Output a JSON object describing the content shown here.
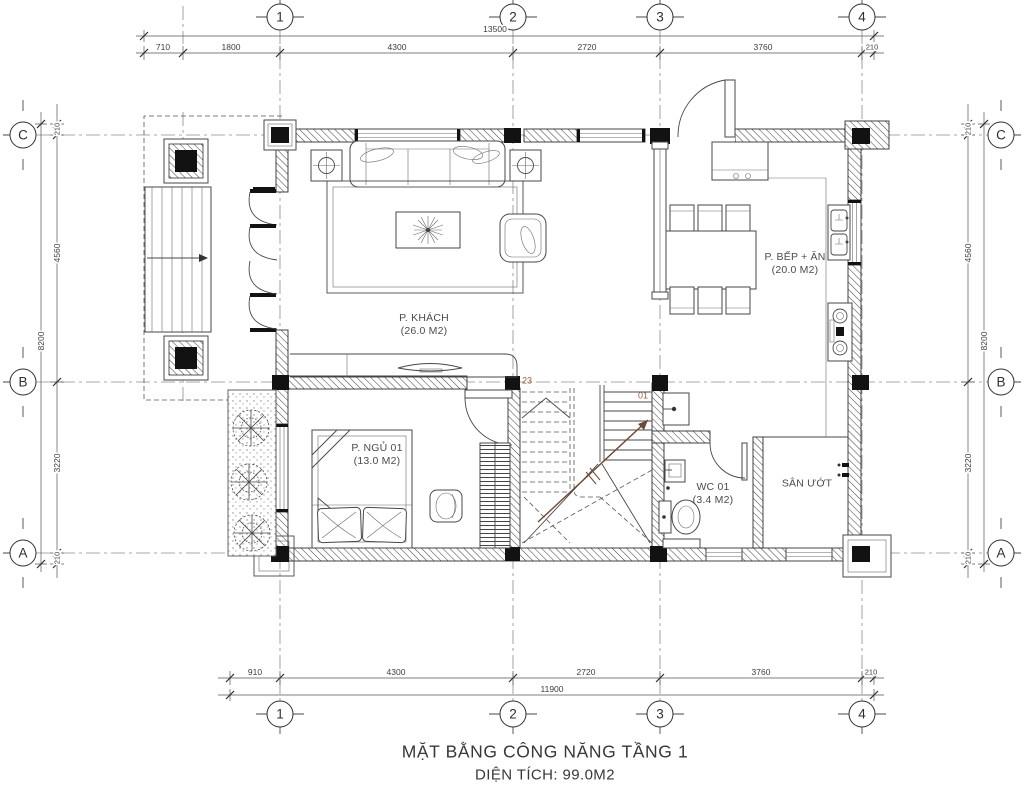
{
  "title": {
    "line1": "MẶT BẰNG CÔNG NĂNG TẦNG 1",
    "line2": "DIỆN TÍCH: 99.0M2"
  },
  "grid": {
    "cols": [
      "1",
      "2",
      "3",
      "4"
    ],
    "rows": [
      "C",
      "B",
      "A"
    ]
  },
  "dims": {
    "top": {
      "total": "13500",
      "segs": [
        "710",
        "1800",
        "4300",
        "2720",
        "3760",
        "210"
      ]
    },
    "bottom": {
      "total": "11900",
      "segs": [
        "910",
        "4300",
        "2720",
        "3760",
        "210"
      ]
    },
    "left": {
      "total": "8200",
      "segs": [
        "210",
        "4560",
        "3220",
        "210"
      ]
    },
    "right": {
      "total": "8200",
      "segs": [
        "210",
        "4560",
        "3220",
        "210"
      ]
    }
  },
  "rooms": {
    "living": {
      "name": "P. KHÁCH",
      "area": "(26.0 M2)"
    },
    "kitchen": {
      "name": "P. BẾP + ĂN",
      "area": "(20.0 M2)"
    },
    "bedroom": {
      "name": "P. NGỦ 01",
      "area": "(13.0 M2)"
    },
    "wc": {
      "name": "WC 01",
      "area": "(3.4 M2)"
    },
    "wetyard": {
      "name": "SÂN ƯỚT",
      "area": ""
    }
  },
  "stair": {
    "first_step": "01",
    "last_step": "23"
  },
  "colors": {
    "line": "#3e3e3e",
    "stair_label": "#9c5a3c"
  }
}
